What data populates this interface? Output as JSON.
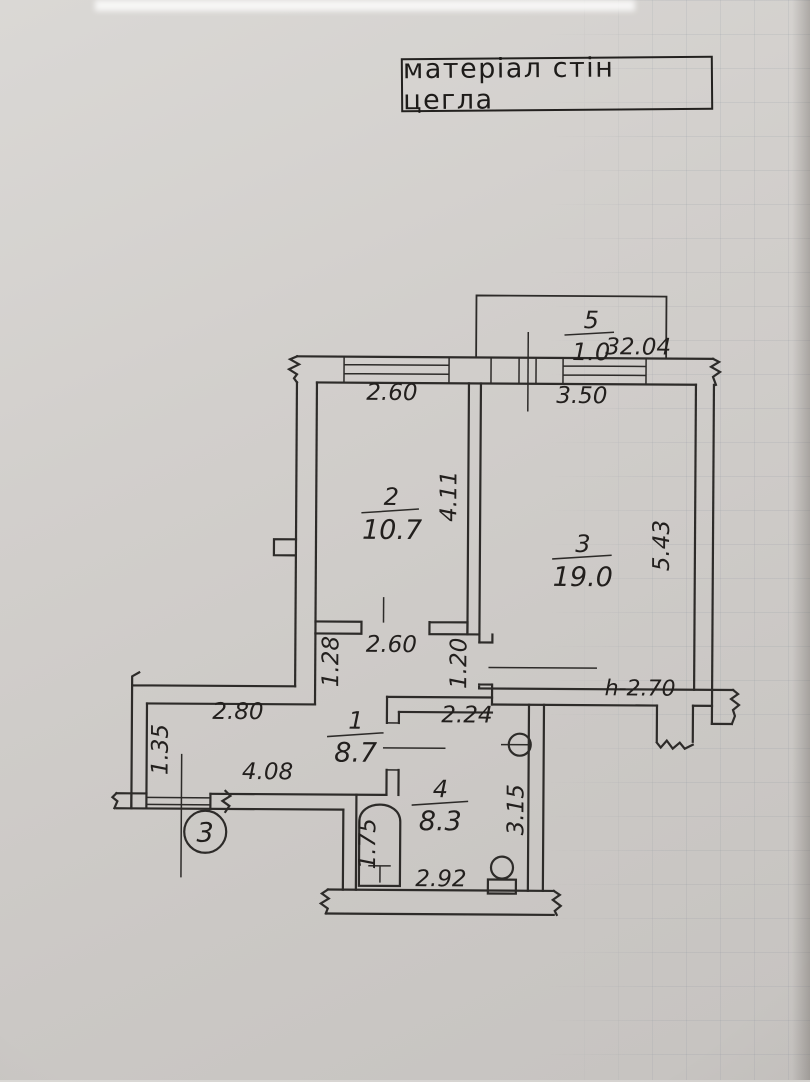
{
  "title_box": {
    "label": "матеріал стін цегла"
  },
  "plan": {
    "total_area": "32.04",
    "ceiling_height": "h-2.70",
    "entrance_section_marker": "3",
    "rooms": [
      {
        "number": "1",
        "area": "8.7"
      },
      {
        "number": "2",
        "area": "10.7"
      },
      {
        "number": "3",
        "area": "19.0"
      },
      {
        "number": "4",
        "area": "8.3"
      },
      {
        "number": "5",
        "area": "1.0"
      }
    ],
    "dimensions": {
      "room2_width": "2.60",
      "room2_depth": "4.11",
      "room3_width": "3.50",
      "room3_depth": "5.43",
      "hall_width": "2.60",
      "hall_wall_left": "1.28",
      "room3_door": "1.20",
      "corridor_top": "2.80",
      "corridor_left": "1.35",
      "corridor_length": "4.08",
      "room4_top_width": "2.24",
      "room4_depth": "3.15",
      "room4_bottom_width": "2.92",
      "bathtub_length": "1.75"
    }
  }
}
